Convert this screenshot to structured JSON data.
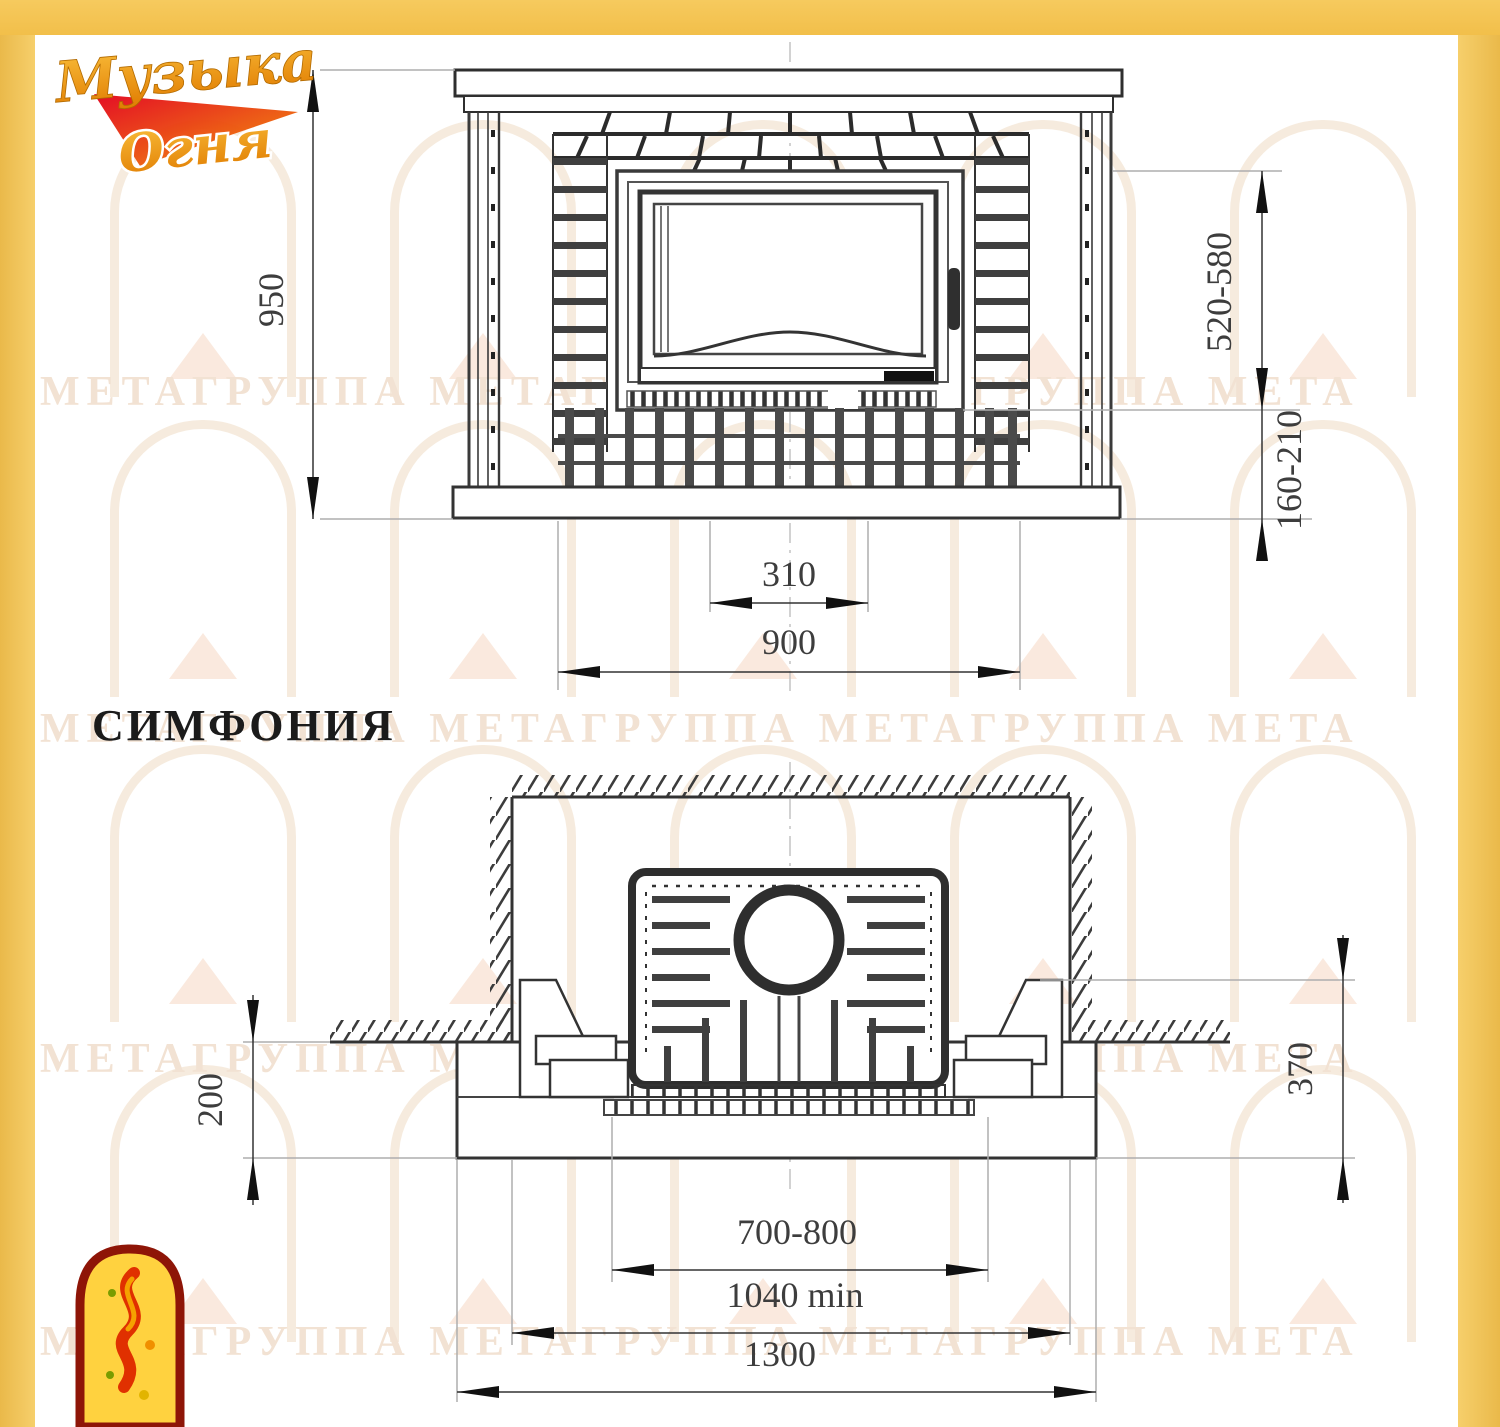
{
  "colors": {
    "frame_yellow": "#f4c557",
    "line_dark": "#2e2e2e",
    "line_gray": "#adadad",
    "dim_text": "#3d3d3d",
    "logo_gold": "#f2a71b",
    "logo_red": "#e2001a",
    "emblem_yellow": "#ffd23f",
    "emblem_red": "#8e1507",
    "watermark": "#f2e2d3"
  },
  "logo": {
    "line1": "Музыка",
    "line2": "Огня"
  },
  "title": "СИМФОНИЯ",
  "watermark_text": "МЕТАГРУППА МЕТАГРУППА МЕТАГРУППА МЕТА",
  "front_view": {
    "dim_height": "950",
    "dim_firebox_range": "520-580",
    "dim_hearth_range": "160-210",
    "dim_vent_width": "310",
    "dim_body_width": "900"
  },
  "plan_view": {
    "dim_left_offset": "200",
    "dim_right_offset": "370",
    "dim_insert_width": "700-800",
    "dim_niche_width": "1040 min",
    "dim_platform_width": "1300"
  }
}
